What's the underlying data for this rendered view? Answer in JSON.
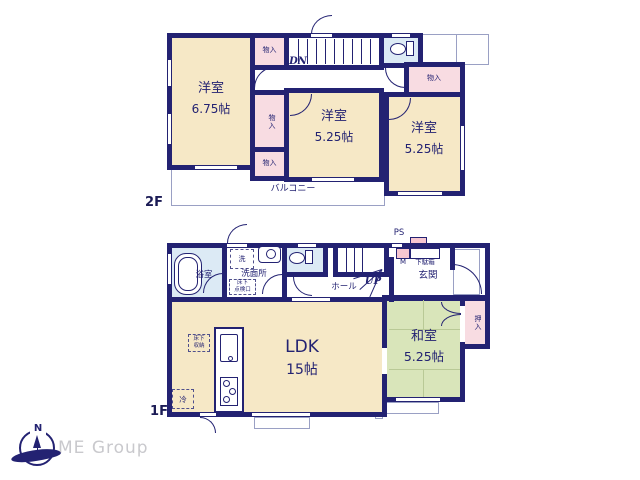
{
  "floor2": {
    "label": "2F",
    "bedroom1": {
      "name": "洋室",
      "size": "6.75帖"
    },
    "bedroom2": {
      "name": "洋室",
      "size": "5.25帖"
    },
    "bedroom3": {
      "name": "洋室",
      "size": "5.25帖"
    },
    "closet_top": {
      "label": "物入"
    },
    "closet_mid": {
      "label": "物入"
    },
    "closet_low": {
      "label": "物入"
    },
    "closet_right": {
      "label": "物入"
    },
    "stairs": {
      "label": "DN"
    },
    "balcony": {
      "label": "バルコニー"
    }
  },
  "floor1": {
    "label": "1F",
    "bath": {
      "label": "浴室"
    },
    "washer": {
      "label": "洗"
    },
    "washroom": {
      "label": "洗面所"
    },
    "inspection": {
      "label": "床下\n点検口"
    },
    "hall": {
      "label": "ホール"
    },
    "stairs": {
      "label": "UP"
    },
    "ps": {
      "label": "PS"
    },
    "meter": {
      "label": "M"
    },
    "shoebox": {
      "label": "下駄箱"
    },
    "entrance": {
      "label": "玄関"
    },
    "ldk": {
      "name": "LDK",
      "size": "15帖"
    },
    "storage": {
      "label": "床下\n収納"
    },
    "fridge": {
      "label": "冷"
    },
    "washitsu": {
      "name": "和室",
      "size": "5.25帖"
    },
    "oshiire": {
      "label": "押入"
    }
  },
  "compass": {
    "north": "N"
  },
  "brand": {
    "name": "ME Group"
  },
  "colors": {
    "wall": "#232272",
    "western_room": "#f6e8c6",
    "closet": "#f8dce2",
    "wet_area": "#dceaf5",
    "tatami_room": "#d9e5ba",
    "brand_text": "#c9c9cd"
  }
}
